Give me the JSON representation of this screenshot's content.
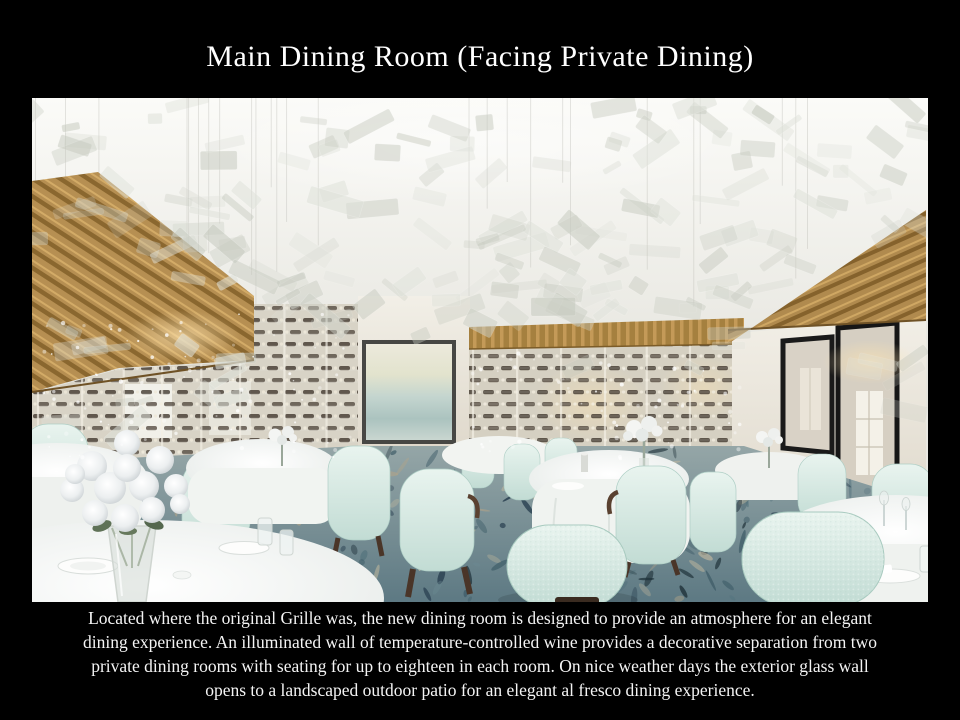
{
  "header": {
    "title": "Main Dining Room (Facing Private Dining)"
  },
  "photo": {
    "description": "Rendering of the main dining room: suspended translucent panel ceiling installation, wood slat canopies, glass temperature-controlled wine walls, framed abstract artwork, round tables with white linens and rose centerpiece, seafoam tub chairs, patterned blue carpet, black-framed glass doors"
  },
  "caption": {
    "lines": [
      "Located where the original Grille was, the new dining room is designed to provide an atmosphere for an elegant",
      "dining experience. An illuminated wall of temperature-controlled wine provides a decorative separation from two",
      "private dining rooms with seating for up to eighteen in each room. On nice weather days the exterior glass wall",
      "opens to a landscaped outdoor patio for an elegant al fresco dining experience."
    ]
  },
  "colors": {
    "background": "#000000",
    "title_text": "#ffffff",
    "caption_text": "#f4f4f4",
    "ceiling": "#f5f4f0",
    "panels": [
      "#cdd0c6",
      "#dfe2da",
      "#c6cabf"
    ],
    "wood": "#b68f52",
    "wood_dark": "#8a672f",
    "wine_glass_wall": "#d8d3c6",
    "wine_bottle": "#3e352b",
    "wall": "#ece7db",
    "door_frame": "#1a1a1a",
    "artwork_teal": "#b7cdc8",
    "chair": "#d6e9e2",
    "chair_leg": "#4a3528",
    "table_linen": "#f6f7f4",
    "carpet_base": "#87999c",
    "carpet_specks": [
      "#22384a",
      "#3c5a66",
      "#6d8c94",
      "#b3a488",
      "#55747e",
      "#1e3038",
      "#c3b99f"
    ]
  }
}
